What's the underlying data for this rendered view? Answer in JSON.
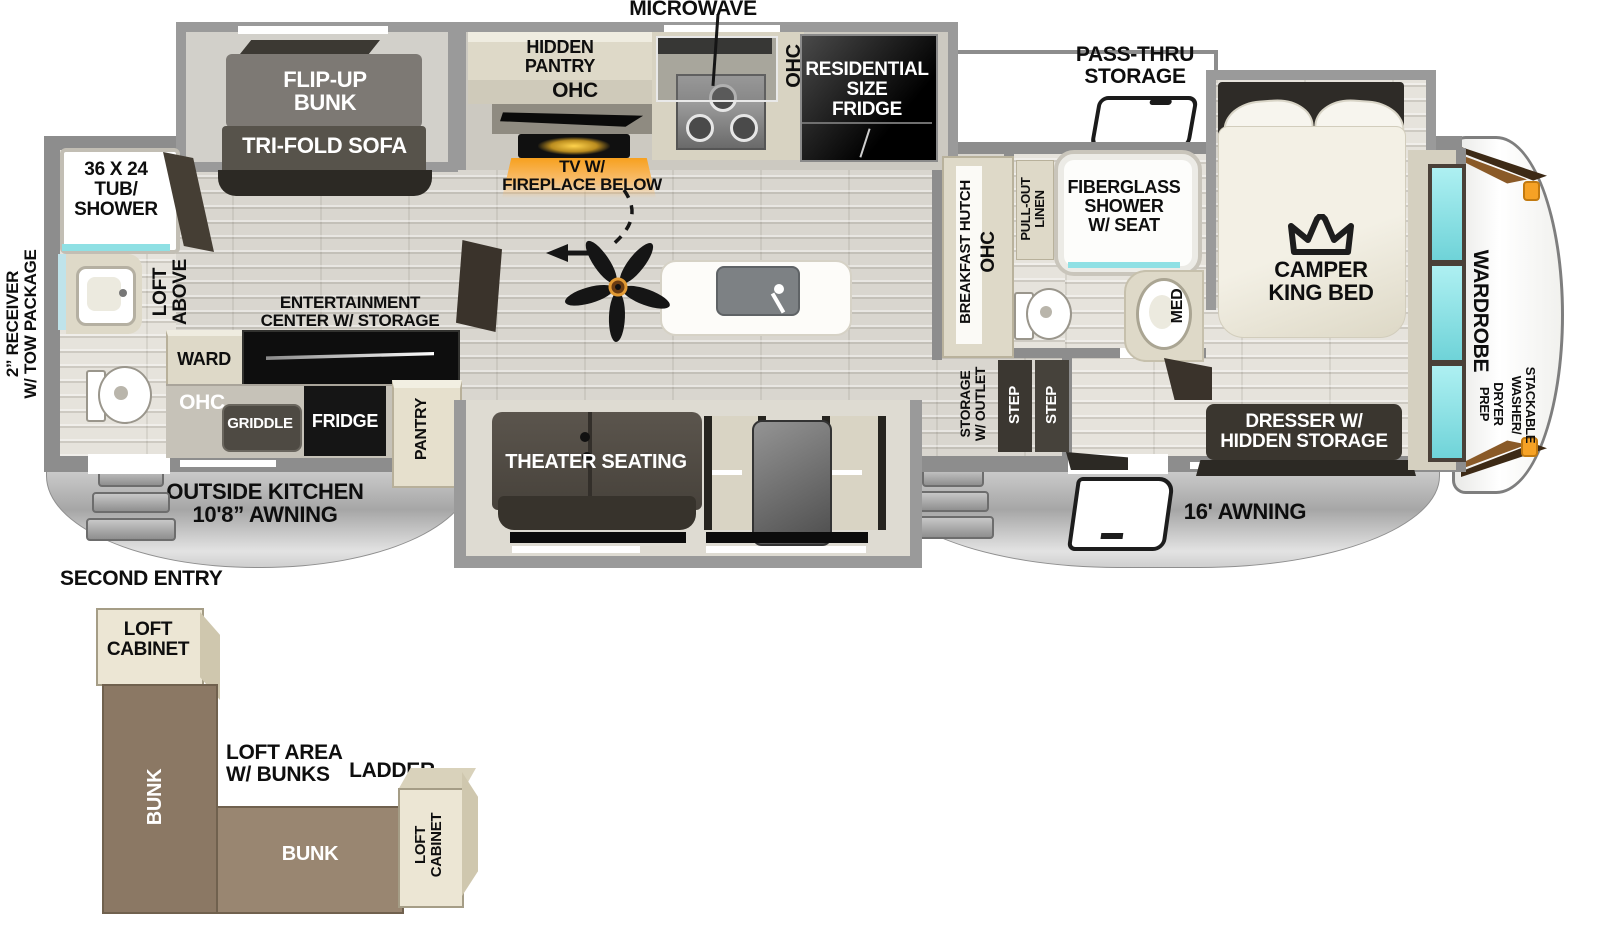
{
  "colors": {
    "accent_orange": "#f5a127",
    "fireplace_glow": "#f7a01e",
    "mirror_cyan": "#8fe0e4",
    "bunk_brown": "#8b7864",
    "wall_gray": "#8d8d8d",
    "furniture_dark": "#2c2924"
  },
  "slides": {
    "bunk1": "FLIP-UP",
    "bunk2": "BUNK",
    "sofa": "TRI-FOLD SOFA"
  },
  "kitchen": {
    "microwave": "MICROWAVE",
    "hidden_pantry1": "HIDDEN",
    "hidden_pantry2": "PANTRY",
    "ohc": "OHC",
    "ohc_range": "OHC",
    "tv1": "TV W/",
    "tv2": "FIREPLACE BELOW",
    "fridge1": "RESIDENTIAL",
    "fridge2": "SIZE",
    "fridge3": "FRIDGE",
    "hutch": "BREAKFAST HUTCH",
    "hutch_ohc": "OHC"
  },
  "rear_bath": {
    "tub1": "36 X 24",
    "tub2": "TUB/",
    "tub3": "SHOWER",
    "loft1": "LOFT",
    "loft2": "ABOVE"
  },
  "living": {
    "ent1": "ENTERTAINMENT",
    "ent2": "CENTER W/ STORAGE",
    "ward": "WARD",
    "pantry": "PANTRY",
    "theater": "THEATER SEATING"
  },
  "outside_kitchen": {
    "ohc": "OHC",
    "griddle": "GRIDDLE",
    "fridge": "FRIDGE",
    "awning1": "OUTSIDE KITCHEN",
    "awning2": "10'8” AWNING"
  },
  "mid_bath": {
    "linen1": "PULL-OUT",
    "linen2": "LINEN",
    "shower1": "FIBERGLASS",
    "shower2": "SHOWER",
    "shower3": "W/ SEAT",
    "med": "MED"
  },
  "bedroom": {
    "passthru1": "PASS-THRU",
    "passthru2": "STORAGE",
    "bed1": "CAMPER",
    "bed2": "KING BED",
    "dresser1": "DRESSER W/",
    "dresser2": "HIDDEN STORAGE",
    "storage1": "STORAGE",
    "storage2": "W/ OUTLET",
    "step": "STEP",
    "wardrobe": "WARDROBE",
    "washer1": "STACKABLE",
    "washer2": "WASHER/",
    "dryer1": "DRYER",
    "dryer2": "PREP"
  },
  "exterior": {
    "awning_right": "16' AWNING",
    "receiver1": "2” RECEIVER",
    "receiver2": "W/ TOW PACKAGE",
    "second_entry": "SECOND ENTRY"
  },
  "loft": {
    "cab1a": "LOFT",
    "cab1b": "CABINET",
    "cab2a": "LOFT",
    "cab2b": "CABINET",
    "bunk_v": "BUNK",
    "bunk_h": "BUNK",
    "area1": "LOFT AREA",
    "area2": "W/ BUNKS",
    "ladder": "LADDER"
  }
}
